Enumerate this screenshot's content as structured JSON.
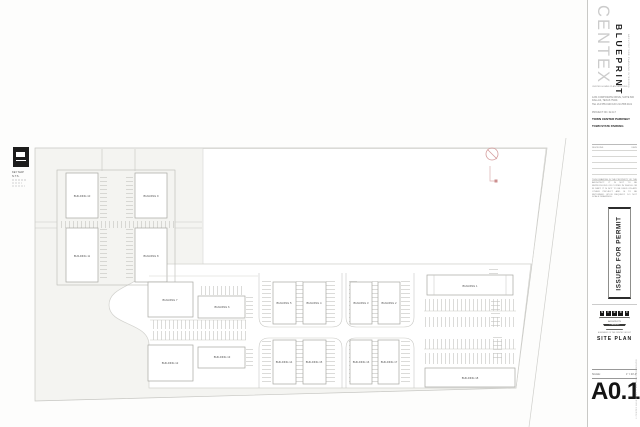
{
  "titleblock": {
    "brand": {
      "name": "CENTEX",
      "subname": "BLUEPRINT",
      "tagline": "ARCHITECTURE  PLANNING  INTERIORS",
      "division": "CENTEX HOMES PLAN SERVICES"
    },
    "firm": {
      "line1": "1234 CORPORATE DRIVE, SUITE 600",
      "line2": "DALLAS, TEXAS 75201",
      "line3": "TEL 214.555.0100  FAX 214.555.0101"
    },
    "project": {
      "number": "PROJECT NO. 02-117",
      "name": "TOWN CENTER PARKWAY",
      "name2": "TOWN STATE PARKING"
    },
    "revisions": {
      "header_left": "REVISIONS",
      "header_right": "DATE"
    },
    "disclaimer": "THIS DRAWING IS THE PROPERTY OF THE ARCHITECT. IT IS NOT TO BE REPRODUCED OR COPIED IN WHOLE OR IN PART. IT IS NOT TO BE USED ON ANY OTHER PROJECT AND IS TO BE RETURNED UPON REQUEST. DO NOT SCALE DRAWINGS.",
    "status_stamp": "ISSUED FOR PERMIT",
    "firm_logo": {
      "letters": [
        "N",
        "C",
        "B",
        "D",
        "C"
      ],
      "sub1": "ARCHITECTS",
      "band": "PLANNERS",
      "tag": "A MEMBER OF THE CENTEX GROUP"
    },
    "sheet_title": "SITE PLAN",
    "scale_label": "SCALE:",
    "scale_value": "1\" = 40'-0\"",
    "sheet_number": "A0.1",
    "copyright": "© CENTEX BLUEPRINT — ALL RIGHTS RESERVED"
  },
  "plan": {
    "keymap": {
      "caption1": "KEY MAP",
      "caption2": "N.T.S."
    },
    "buildings": {
      "b1": "BUILDING 1",
      "b2": "BUILDING 2",
      "b3": "BUILDING 3",
      "b4": "BUILDING 4",
      "b5": "BUILDING 5",
      "b6": "BUILDING 6",
      "b7": "BUILDING 7",
      "b8": "BUILDING 8",
      "b9": "BUILDING 9",
      "b10": "BUILDING 10",
      "b11": "BUILDING 11",
      "b12": "BUILDING 12",
      "b13": "BUILDING 13",
      "b14": "BUILDING 14",
      "b15": "BUILDING 15",
      "b16": "BUILDING 16",
      "b17": "BUILDING 17",
      "b18": "BUILDING 18"
    },
    "marker_color": "#d49c9c"
  }
}
